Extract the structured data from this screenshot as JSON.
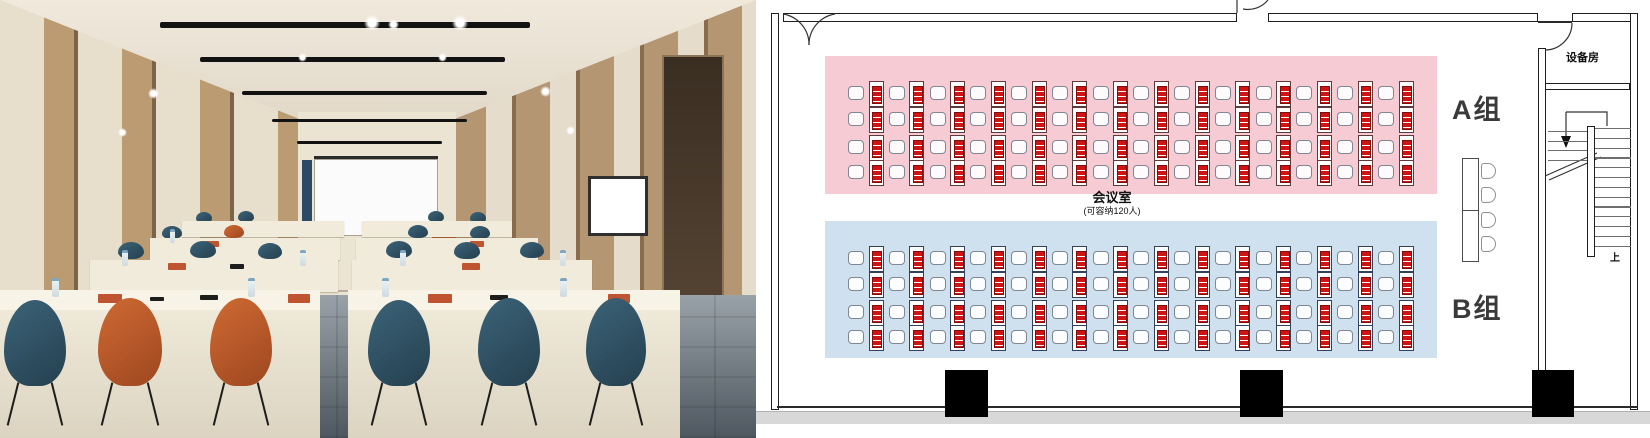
{
  "floor_plan": {
    "room_label": "会议室",
    "capacity_label": "(可容纳120人)",
    "equipment_room_label": "设备房",
    "stairs": {
      "up_label": "上",
      "tread_count": 13,
      "lower_tread_count": 4
    },
    "zones": [
      {
        "id": "A",
        "label": "A组",
        "fill": "#f7cbd4",
        "desk_border": "#5f3a3a",
        "rows": 4,
        "cols": 14
      },
      {
        "id": "B",
        "label": "B组",
        "fill": "#cfe0ef",
        "desk_border": "#33415a",
        "rows": 4,
        "cols": 14
      }
    ],
    "notebook_color": "#d01414",
    "head_table": {
      "seats": 4
    },
    "pillar_count": 3
  },
  "photo": {
    "chair_colors": {
      "blue": "#2f5166",
      "orange": "#bf5727"
    },
    "accent_colors": {
      "screen_stripe_blue": "#2c4a63",
      "wall_accent_orange": "#c05a28"
    }
  }
}
